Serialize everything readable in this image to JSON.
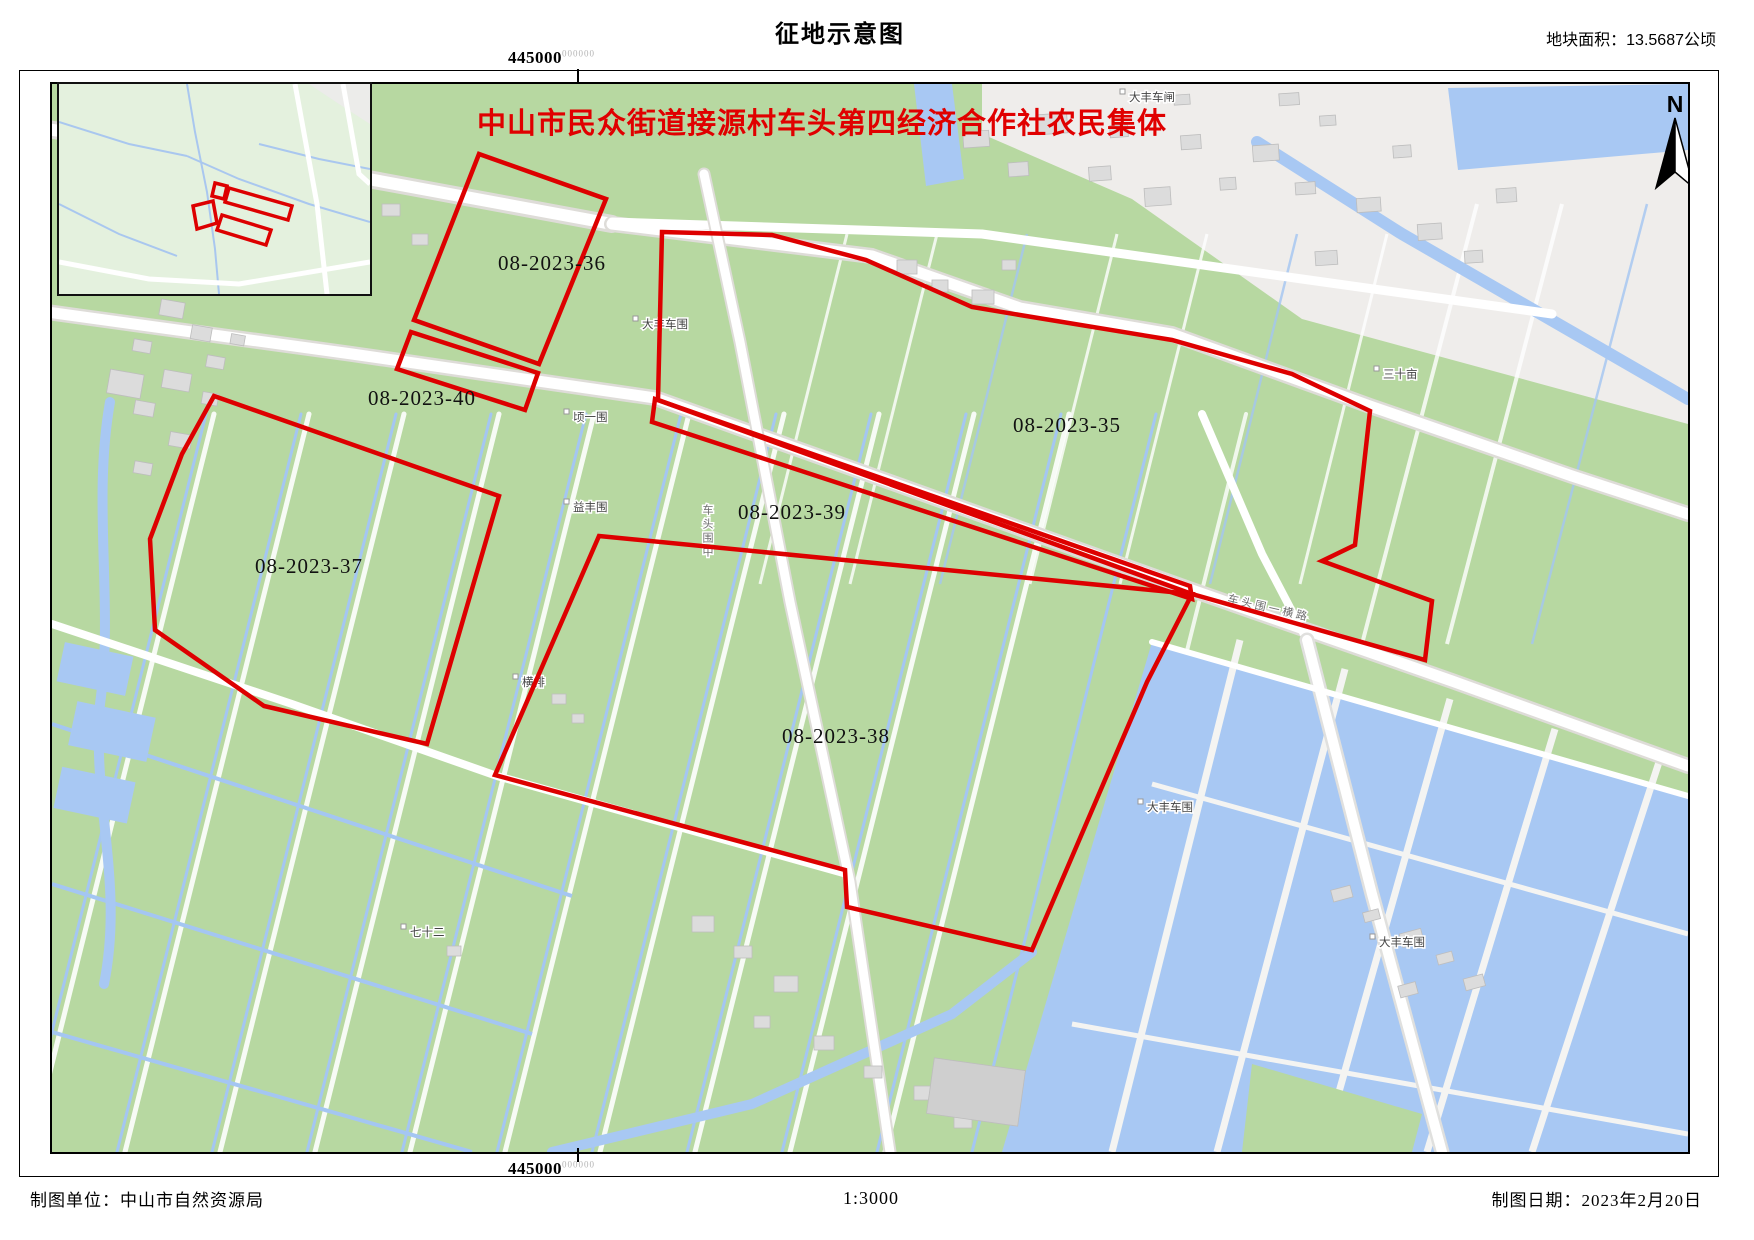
{
  "header": {
    "title": "征地示意图",
    "area_label": "地块面积：13.5687公顷"
  },
  "map": {
    "collective_title": "中山市民众街道接源村车头第四经济合作社农民集体",
    "north_label": "N",
    "top_coordinate": {
      "main": "445000",
      "sup": "000000"
    },
    "bottom_coordinate": {
      "main": "445000",
      "sup": "000000"
    },
    "parcels": [
      {
        "id": "08-2023-36",
        "label": "08-2023-36"
      },
      {
        "id": "08-2023-40",
        "label": "08-2023-40"
      },
      {
        "id": "08-2023-35",
        "label": "08-2023-35"
      },
      {
        "id": "08-2023-39",
        "label": "08-2023-39"
      },
      {
        "id": "08-2023-37",
        "label": "08-2023-37"
      },
      {
        "id": "08-2023-38",
        "label": "08-2023-38"
      }
    ],
    "place_labels": [
      {
        "text": "大丰车闸"
      },
      {
        "text": "大丰车围"
      },
      {
        "text": "三十亩"
      },
      {
        "text": "顷一围"
      },
      {
        "text": "益丰围"
      },
      {
        "text": "横排"
      },
      {
        "text": "七十二"
      },
      {
        "text": "大丰车围"
      },
      {
        "text": "大丰车围"
      },
      {
        "text": "车头围一横路"
      },
      {
        "text": "车头围中"
      }
    ]
  },
  "footer": {
    "unit": "制图单位：中山市自然资源局",
    "scale": "1:3000",
    "date": "制图日期：2023年2月20日"
  },
  "colors": {
    "parcel_outline": "#dd0000",
    "collective_title_red": "#e00000",
    "field_green": "#b7d8a1",
    "water_blue": "#a8c8f3",
    "road_white": "#ffffff",
    "building_gray": "#dcdcdc"
  }
}
